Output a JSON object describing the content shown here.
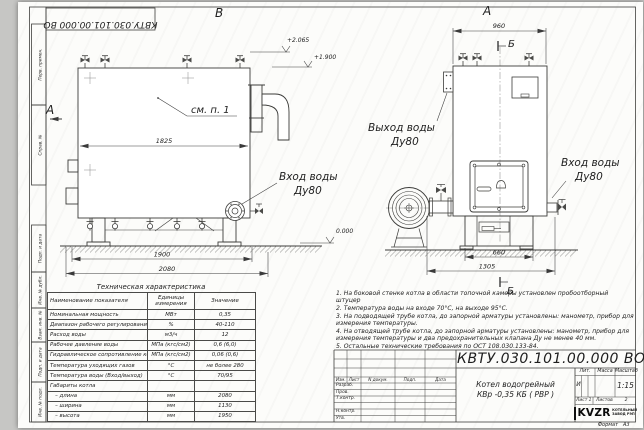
{
  "sheet": {
    "corner_stamp": "КВТУ.030.101.00.000  ВО",
    "margin_boxes": [
      "Перв. примен.",
      "Справ. №",
      "Подп. и дата",
      "Инв. № дубл.",
      "Взам. инв. №",
      "Подп. и дата",
      "Инв. № подл."
    ],
    "format_label": "Формат",
    "format_value": "А3"
  },
  "drawing": {
    "side_view": {
      "view_label": "В",
      "section_label": "А",
      "callout": "см. п. 1",
      "dim_inner_width": "1825",
      "dim_support_span": "1900",
      "dim_overall_length": "2080",
      "elevation_top": "+2.065",
      "elevation_mid": "+1.900",
      "elevation_zero": "0.000",
      "inlet_line1": "Вход воды",
      "inlet_line2": "Ду80"
    },
    "front_view": {
      "view_label": "А",
      "section_mark_top": "Б",
      "section_mark_bottom": "Б",
      "dim_top_width": "960",
      "dim_base_inner": "660",
      "dim_base_overall": "1305",
      "outlet_line1": "Выход воды",
      "outlet_line2": "Ду80",
      "inlet_line1": "Вход воды",
      "inlet_line2": "Ду80"
    }
  },
  "spec_table": {
    "title": "Техническая характеристика",
    "col_headers": [
      "Наименование показателя",
      "Единицы измерения",
      "Значение"
    ],
    "rows": [
      [
        "Номинальная мощность",
        "МВт",
        "0,35"
      ],
      [
        "Диапазон рабочего регулирования",
        "%",
        "40-110"
      ],
      [
        "Расход воды",
        "м3/ч",
        "12"
      ],
      [
        "Рабочее давление воды",
        "МПа (кгс/см2)",
        "0,6 (6,0)"
      ],
      [
        "Гидравлическое сопротивление котла",
        "МПа (кгс/см2)",
        "0,06 (0,6)"
      ],
      [
        "Температура уходящих газов",
        "°С",
        "не более 280"
      ],
      [
        "Температура воды (Вход/выход)",
        "°С",
        "70/95"
      ],
      [
        "Габариты котла",
        "",
        ""
      ],
      [
        "   – длина",
        "мм",
        "2080"
      ],
      [
        "   – ширина",
        "мм",
        "1130"
      ],
      [
        "   – высота",
        "мм",
        "1950"
      ]
    ]
  },
  "notes": [
    "1.  На боковой стенке котла в области топочной камеры установлен пробоотборный штуцер",
    "2.  Температура воды на входе 70°С, на выходе 95°С.",
    "3.  На подводящей трубе котла, до запорной арматуры установлены: манометр, прибор для измерения температуры.",
    "4.  На отводящей трубе котла, до запорной арматуры установлены: манометр, прибор для измерения температуры и два предохранительных клапана  Ду не менее 40 мм.",
    "5.  Остальные технические требования по ОСТ 108.030.133-84."
  ],
  "title_block": {
    "doc_number": "КВТУ.030.101.00.000  ВО",
    "product_line1": "Котел водогрейный",
    "product_line2": "КВр -0,35  КБ  ( РВР )",
    "change_headers": [
      "Изм.",
      "Лист",
      "N докум.",
      "Подп.",
      "Дата"
    ],
    "role_rows": [
      "Разраб.",
      "Пров.",
      "Т.контр.",
      "",
      "Н.контр.",
      "Утв."
    ],
    "lit_header": "Лит.",
    "lit_value": "И",
    "mass_header": "Масса",
    "scale_header": "Масштаб",
    "scale_value": "1:15",
    "sheet_label": "Лист",
    "sheet_value": "1",
    "sheets_label": "Листов",
    "sheets_value": "2",
    "company_logo": "KVZR",
    "company_line1": "КОТЕЛЬНЫЙ",
    "company_line2": "ЗАВОД РЭП"
  }
}
